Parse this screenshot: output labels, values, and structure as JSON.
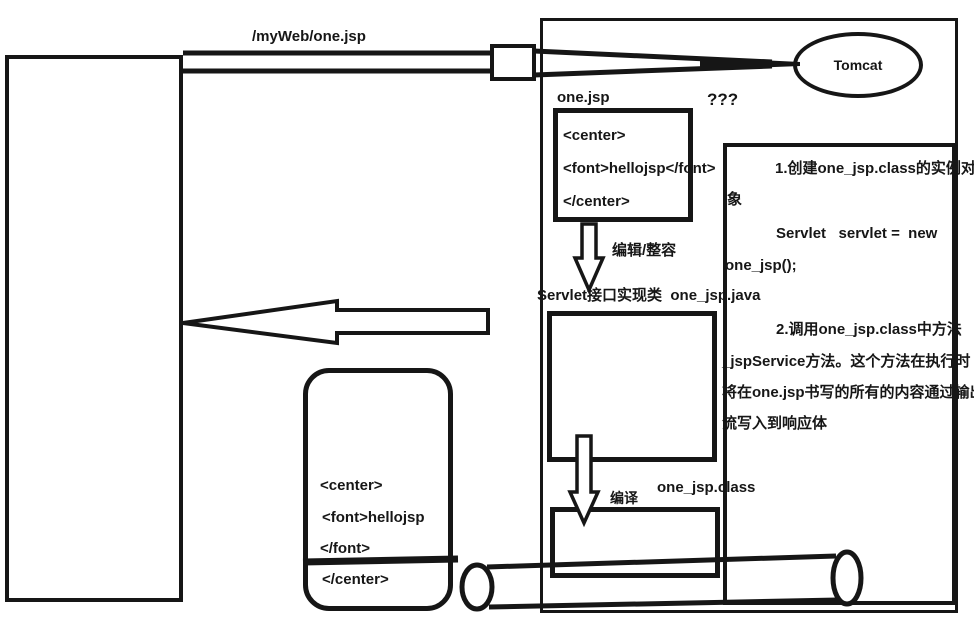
{
  "colors": {
    "ink": "#161616",
    "background": "#ffffff"
  },
  "request_arrow": {
    "label": "/myWeb/one.jsp"
  },
  "server": {
    "name": "Tomcat"
  },
  "jsp_file": {
    "title": "one.jsp",
    "question": "???",
    "lines": [
      "<center>",
      "<font>hellojsp</font>",
      "</center>"
    ]
  },
  "translate_step": {
    "label": "编辑/整容"
  },
  "servlet_class": {
    "caption": "Servlet接口实现类  one_jsp.java"
  },
  "compile_step": {
    "label": "编译",
    "output": "one_jsp.class"
  },
  "note_panel": {
    "lines": [
      "1.创建one_jsp.class的实例对",
      "象",
      "Servlet   servlet =  new",
      "one_jsp();",
      "2.调用one_jsp.class中方法",
      "_jspService方法。这个方法在执行时",
      "将在one.jsp书写的所有的内容通过输出",
      "流写入到响应体"
    ]
  },
  "response_page": {
    "lines": [
      "<center>",
      "<font>hellojsp",
      "</font>",
      "</center>"
    ]
  }
}
